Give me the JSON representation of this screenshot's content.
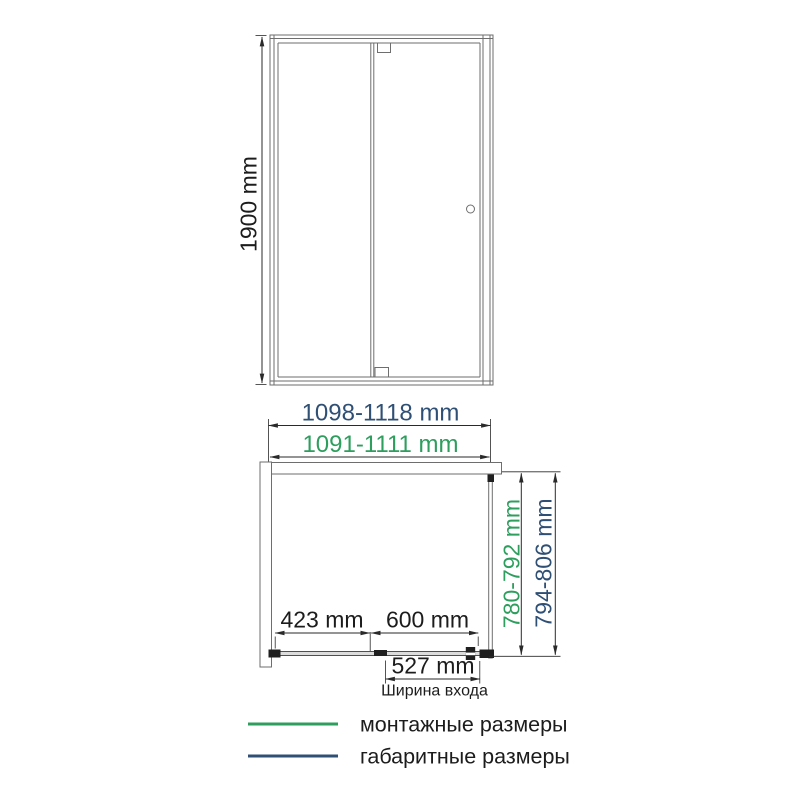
{
  "colors": {
    "green": "#2E9E5E",
    "navy": "#2F4F74",
    "outline": "#6E6E6E",
    "dimension_line": "#2A2A2A",
    "text": "#1C1C1C"
  },
  "front_view": {
    "height": "1900 mm"
  },
  "top_view": {
    "overall_width": "1098-1118 mm",
    "mounting_width": "1091-1111 mm",
    "mounting_depth": "780-792 mm",
    "overall_depth": "794-806 mm",
    "fixed_segment": "423 mm",
    "door_segment": "600 mm",
    "entrance_width": "527 mm",
    "entrance_label": "Ширина входа"
  },
  "legend": {
    "items": [
      {
        "label": "монтажные размеры",
        "color": "#2E9E5E"
      },
      {
        "label": "габаритные размеры",
        "color": "#2F4F74"
      }
    ]
  }
}
